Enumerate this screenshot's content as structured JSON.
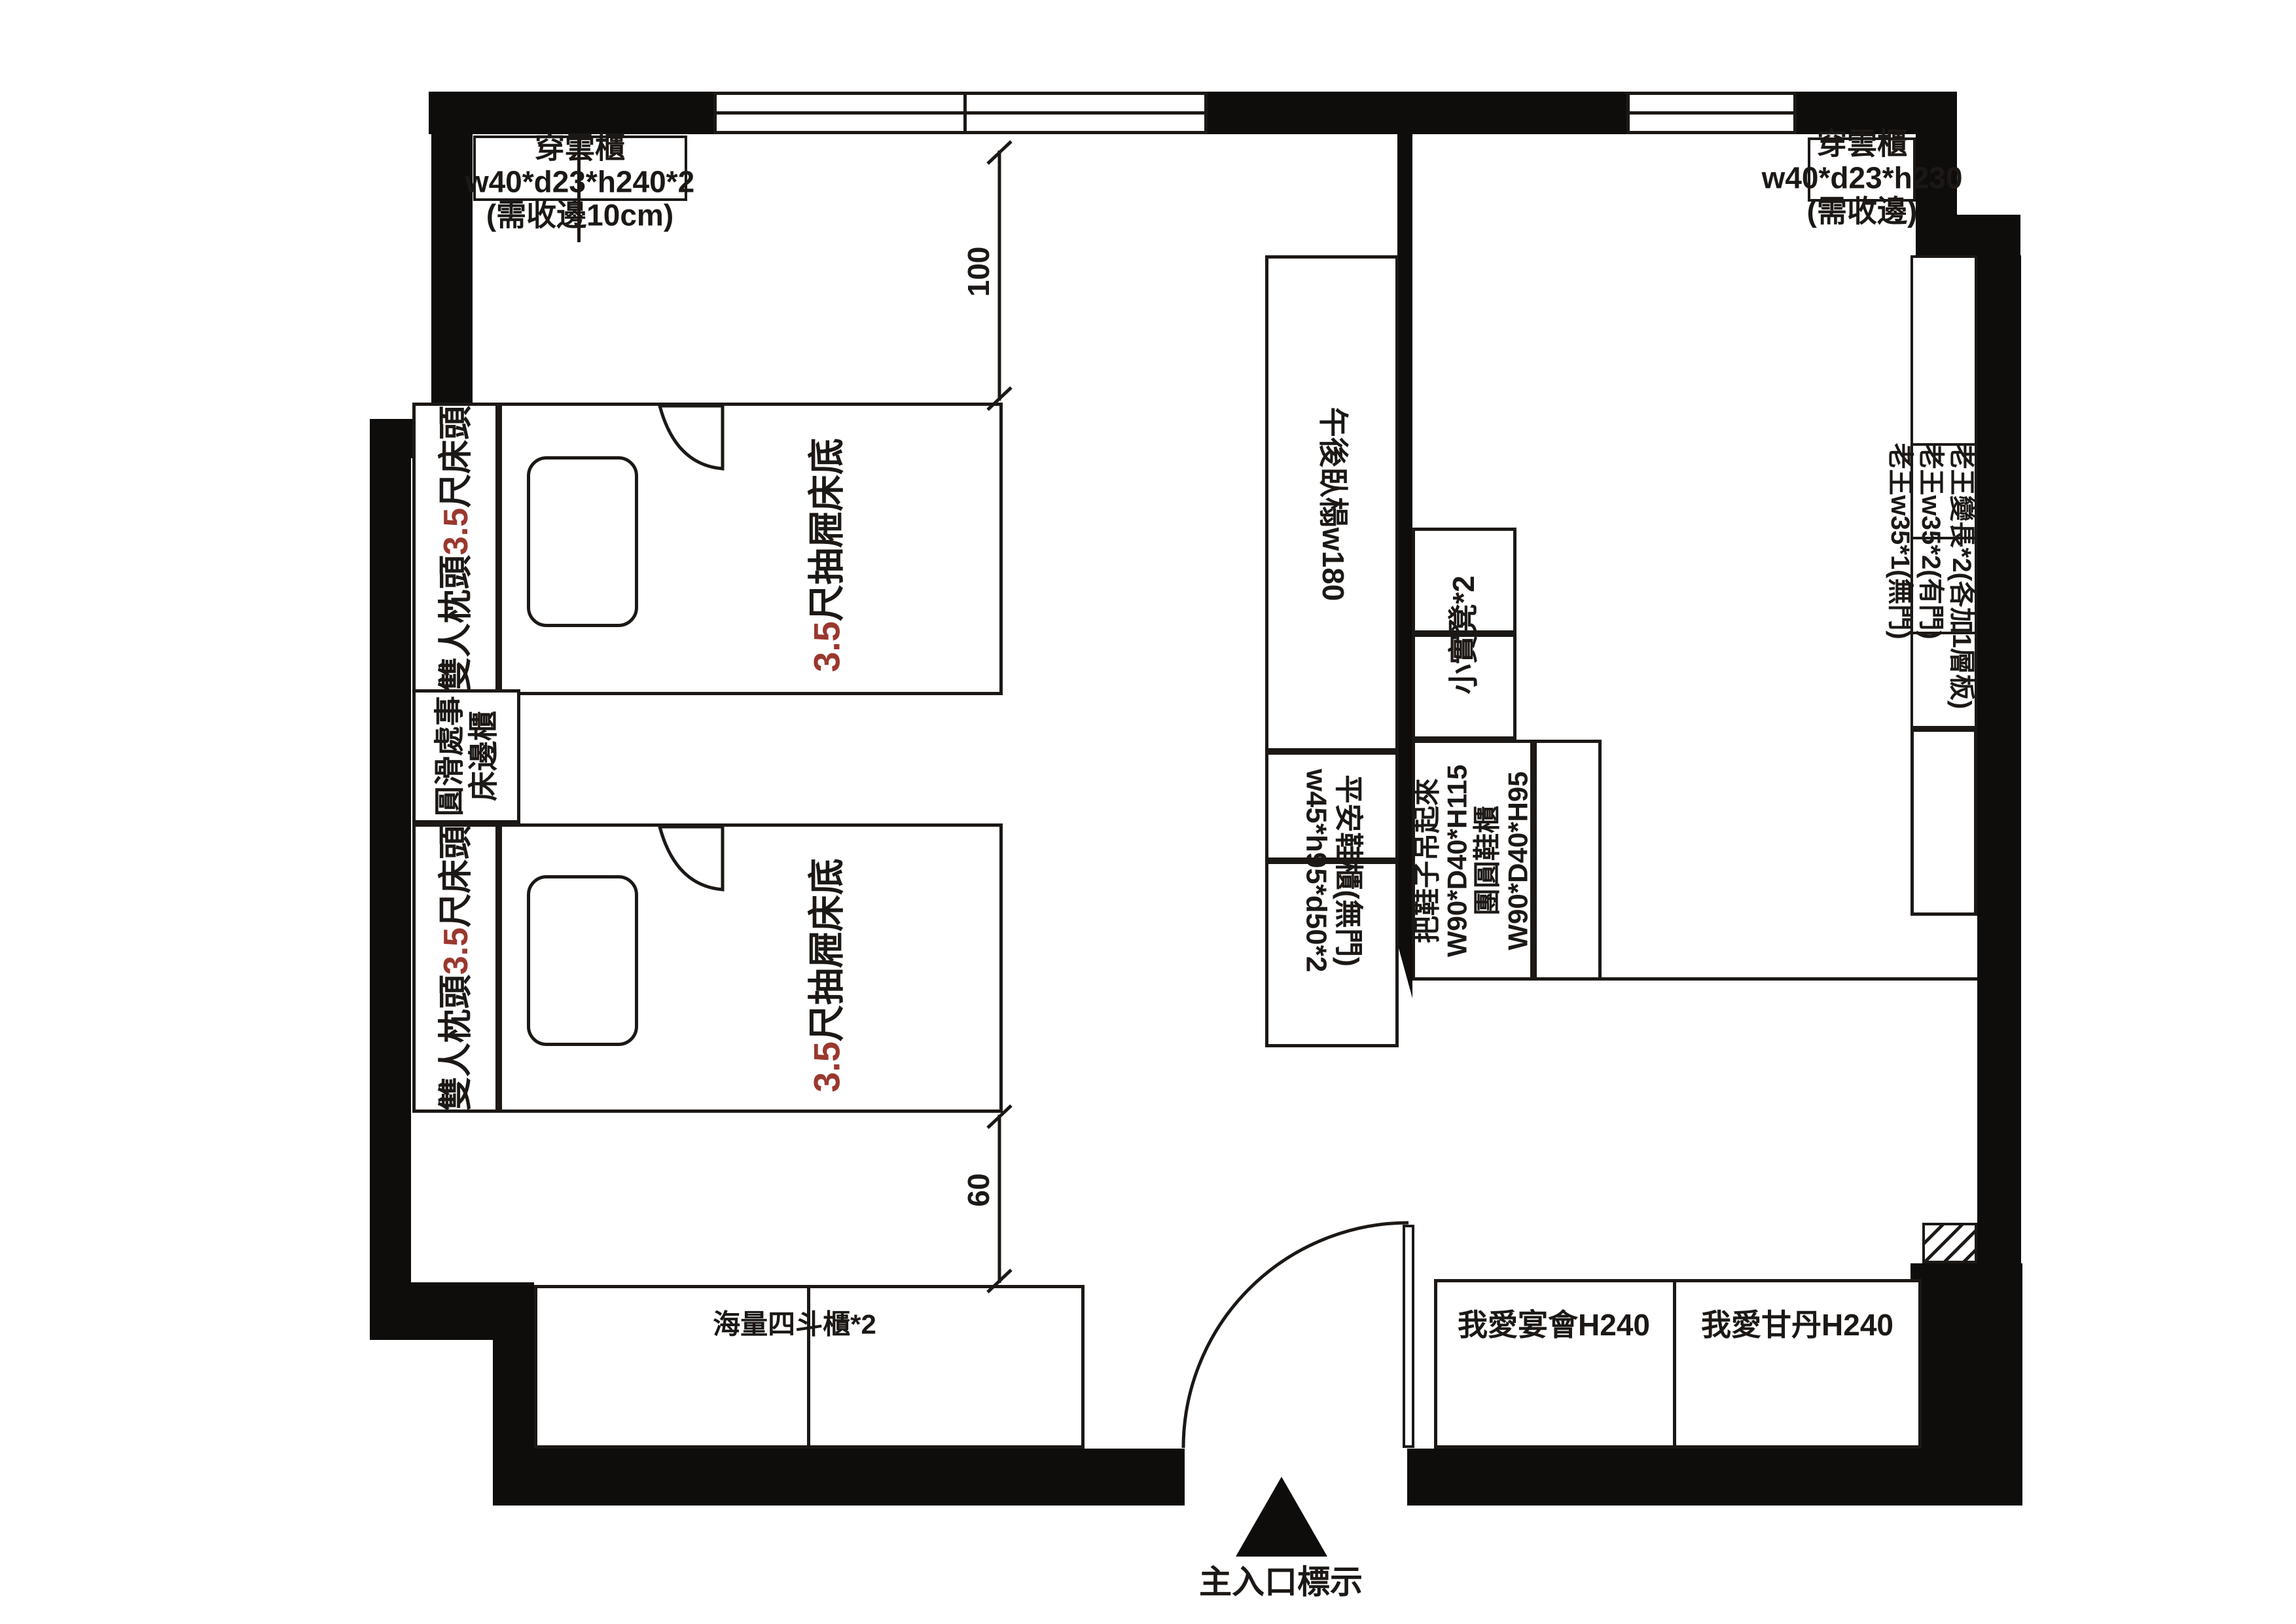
{
  "colors": {
    "wall": "#0f0d0b",
    "line": "#1c1815",
    "accent_red": "#9a382e"
  },
  "labels": {
    "closet_left": {
      "l1": "穿雲櫃",
      "l2": "w40*d23*h240*2",
      "l3": "(需收邊10cm)"
    },
    "closet_right": {
      "l1": "穿雲櫃",
      "l2": "w40*d23*h230",
      "l3": "(需收邊)"
    },
    "bed_head": {
      "pre": "雙人枕頭",
      "num": "3.5",
      "suf": "尺床頭"
    },
    "bed_base": {
      "num": "3.5",
      "suf": "尺抽屜床底"
    },
    "bedside": {
      "l1": "圓滑處事",
      "l2": "床邊櫃"
    },
    "daybed": "午後臥榻w180",
    "stool": "小實凳*2",
    "shoe_open": {
      "l1": "平安鞋櫃(無門)",
      "l2": "w45*h95*d50*2"
    },
    "shoe_hang": {
      "l1": "把鞋子吊起來",
      "l2": "W90*D40*H115",
      "l3": "團圓鞋櫃",
      "l4": "W90*D40*H95"
    },
    "shelf": {
      "l1": "老王變長*2(各加1層板)",
      "l2": "老王w35*2(有門)",
      "l3": "老王w35*1(無門)"
    },
    "chest": "海量四斗櫃*2",
    "cabinet_left": "我愛宴會H240",
    "cabinet_right": "我愛甘丹H240",
    "entrance": "主入口標示"
  },
  "dimensions": {
    "top": "100",
    "bottom": "60"
  }
}
